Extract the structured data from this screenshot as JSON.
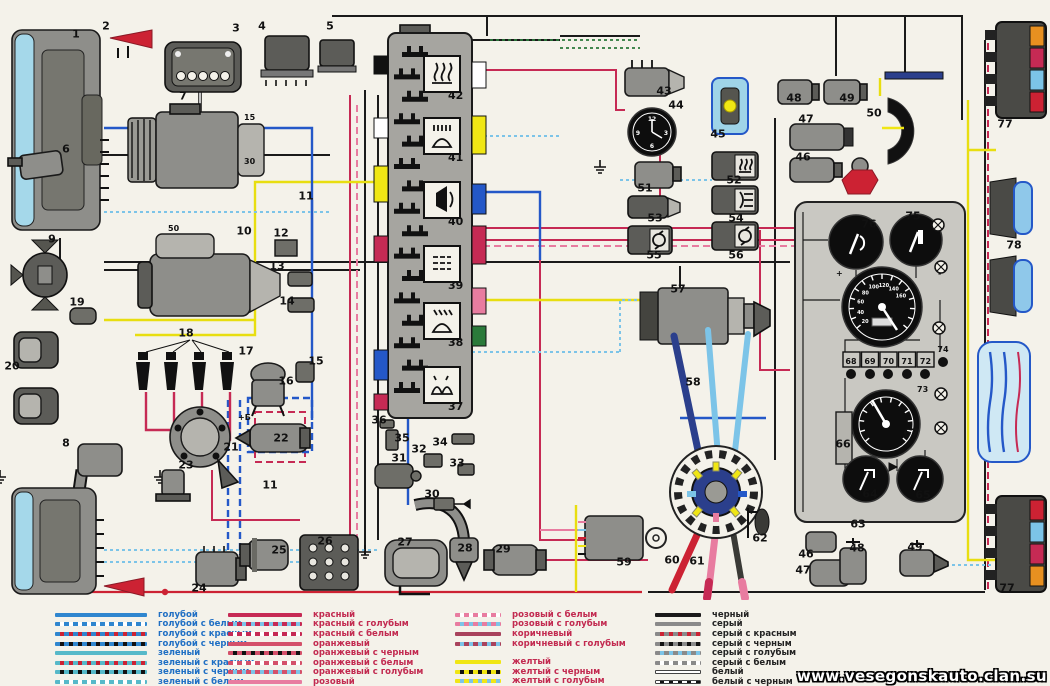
{
  "watermark": "www.vesegonskauto.clan.su",
  "labels": {
    "coil_terminal": "+Б",
    "starter_terminal": "50",
    "gen_terminal_15": "15",
    "gen_terminal_30": "30",
    "plus": "+",
    "minus": "-"
  },
  "fusebox": {
    "icons": [
      {
        "n": "42",
        "icon": "heated-rear-window"
      },
      {
        "n": "41",
        "icon": "high-beam"
      },
      {
        "n": "40",
        "icon": "horn"
      },
      {
        "n": "39",
        "icon": "heater"
      },
      {
        "n": "38",
        "icon": "low-beam"
      },
      {
        "n": "37",
        "icon": "parking-lights"
      }
    ]
  },
  "instrument": {
    "terminals": [
      "68",
      "69",
      "70",
      "71",
      "72"
    ],
    "terminal_73": "73",
    "terminal_74": "74",
    "speedometer_scale": [
      "20",
      "40",
      "60",
      "80",
      "100",
      "120",
      "140",
      "160"
    ],
    "clock_numbers": [
      "12",
      "3",
      "6",
      "9"
    ]
  },
  "callouts": [
    {
      "n": "1",
      "x": 76,
      "y": 34
    },
    {
      "n": "2",
      "x": 106,
      "y": 26
    },
    {
      "n": "3",
      "x": 236,
      "y": 28
    },
    {
      "n": "4",
      "x": 262,
      "y": 26
    },
    {
      "n": "5",
      "x": 330,
      "y": 26
    },
    {
      "n": "6",
      "x": 66,
      "y": 149
    },
    {
      "n": "7",
      "x": 183,
      "y": 96
    },
    {
      "n": "8",
      "x": 66,
      "y": 443
    },
    {
      "n": "9",
      "x": 52,
      "y": 239
    },
    {
      "n": "10",
      "x": 244,
      "y": 231
    },
    {
      "n": "11",
      "x": 306,
      "y": 196
    },
    {
      "n": "11",
      "x": 270,
      "y": 485
    },
    {
      "n": "12",
      "x": 281,
      "y": 233
    },
    {
      "n": "13",
      "x": 277,
      "y": 266
    },
    {
      "n": "14",
      "x": 287,
      "y": 301
    },
    {
      "n": "15",
      "x": 316,
      "y": 361
    },
    {
      "n": "16",
      "x": 286,
      "y": 381
    },
    {
      "n": "17",
      "x": 246,
      "y": 351
    },
    {
      "n": "18",
      "x": 186,
      "y": 333
    },
    {
      "n": "19",
      "x": 77,
      "y": 302
    },
    {
      "n": "20",
      "x": 12,
      "y": 366
    },
    {
      "n": "21",
      "x": 231,
      "y": 447
    },
    {
      "n": "22",
      "x": 281,
      "y": 438
    },
    {
      "n": "23",
      "x": 186,
      "y": 465
    },
    {
      "n": "24",
      "x": 199,
      "y": 588
    },
    {
      "n": "25",
      "x": 279,
      "y": 550
    },
    {
      "n": "26",
      "x": 325,
      "y": 541
    },
    {
      "n": "27",
      "x": 405,
      "y": 542
    },
    {
      "n": "28",
      "x": 465,
      "y": 548
    },
    {
      "n": "29",
      "x": 503,
      "y": 549
    },
    {
      "n": "30",
      "x": 432,
      "y": 494
    },
    {
      "n": "31",
      "x": 399,
      "y": 458
    },
    {
      "n": "32",
      "x": 419,
      "y": 449
    },
    {
      "n": "33",
      "x": 457,
      "y": 463
    },
    {
      "n": "34",
      "x": 440,
      "y": 442
    },
    {
      "n": "35",
      "x": 402,
      "y": 438
    },
    {
      "n": "36",
      "x": 379,
      "y": 420
    },
    {
      "n": "43",
      "x": 664,
      "y": 91
    },
    {
      "n": "44",
      "x": 676,
      "y": 105
    },
    {
      "n": "45",
      "x": 718,
      "y": 134
    },
    {
      "n": "46",
      "x": 803,
      "y": 157
    },
    {
      "n": "47",
      "x": 806,
      "y": 119
    },
    {
      "n": "48",
      "x": 794,
      "y": 98
    },
    {
      "n": "49",
      "x": 847,
      "y": 98
    },
    {
      "n": "50",
      "x": 874,
      "y": 113
    },
    {
      "n": "51",
      "x": 645,
      "y": 188
    },
    {
      "n": "52",
      "x": 734,
      "y": 180
    },
    {
      "n": "53",
      "x": 655,
      "y": 218
    },
    {
      "n": "54",
      "x": 736,
      "y": 218
    },
    {
      "n": "55",
      "x": 654,
      "y": 255
    },
    {
      "n": "56",
      "x": 736,
      "y": 255
    },
    {
      "n": "57",
      "x": 678,
      "y": 289
    },
    {
      "n": "58",
      "x": 693,
      "y": 382
    },
    {
      "n": "59",
      "x": 624,
      "y": 562
    },
    {
      "n": "60",
      "x": 672,
      "y": 560
    },
    {
      "n": "61",
      "x": 697,
      "y": 561
    },
    {
      "n": "62",
      "x": 760,
      "y": 538
    },
    {
      "n": "63",
      "x": 858,
      "y": 524
    },
    {
      "n": "64",
      "x": 870,
      "y": 494
    },
    {
      "n": "65",
      "x": 923,
      "y": 495
    },
    {
      "n": "66",
      "x": 843,
      "y": 444
    },
    {
      "n": "67",
      "x": 911,
      "y": 433
    },
    {
      "n": "75",
      "x": 913,
      "y": 216
    },
    {
      "n": "76",
      "x": 869,
      "y": 224
    },
    {
      "n": "77",
      "x": 1005,
      "y": 124
    },
    {
      "n": "77",
      "x": 1007,
      "y": 588
    },
    {
      "n": "78",
      "x": 1014,
      "y": 245
    },
    {
      "n": "46",
      "x": 806,
      "y": 554
    },
    {
      "n": "47",
      "x": 803,
      "y": 570
    },
    {
      "n": "48",
      "x": 857,
      "y": 548
    },
    {
      "n": "49",
      "x": 915,
      "y": 547
    }
  ],
  "legend": {
    "groups": [
      {
        "text_color": "#1f6fc4",
        "items": [
          {
            "label": "голубой",
            "base": "#2f86cf"
          },
          {
            "label": "голубой с белым",
            "base": "#2f86cf",
            "mark": "#ffffff"
          },
          {
            "label": "голубой с красным",
            "base": "#2f86cf",
            "mark": "#cc2233"
          },
          {
            "label": "голубой с черным",
            "base": "#2f86cf",
            "mark": "#111111"
          },
          {
            "label": "зеленый",
            "base": "#56b9c9"
          },
          {
            "label": "зеленый с красным",
            "base": "#56b9c9",
            "mark": "#cc2233"
          },
          {
            "label": "зеленый с черным",
            "base": "#56b9c9",
            "mark": "#111111"
          },
          {
            "label": "зеленый с белым",
            "base": "#56b9c9",
            "mark": "#ffffff"
          }
        ]
      },
      {
        "text_color": "#c22a50",
        "items": [
          {
            "label": "красный",
            "base": "#c62a54"
          },
          {
            "label": "красный с голубым",
            "base": "#c62a54",
            "mark": "#7cc4e8"
          },
          {
            "label": "красный с белым",
            "base": "#c62a54",
            "mark": "#ffffff"
          },
          {
            "label": "оранжевый",
            "base": "#d4506a"
          },
          {
            "label": "оранжевый с черным",
            "base": "#d4506a",
            "mark": "#111111"
          },
          {
            "label": "оранжевый с белым",
            "base": "#d4506a",
            "mark": "#ffffff"
          },
          {
            "label": "оранжевый с голубым",
            "base": "#d4506a",
            "mark": "#7cc4e8"
          },
          {
            "label": "розовый",
            "base": "#e87ca0"
          },
          {
            "label": "розовый с черным",
            "base": "#e87ca0",
            "mark": "#111111"
          }
        ]
      },
      {
        "text_color": "#c22a50",
        "items": [
          {
            "label": "розовый с белым",
            "base": "#e87ca0",
            "mark": "#ffffff"
          },
          {
            "label": "розовый с голубым",
            "base": "#e87ca0",
            "mark": "#7cc4e8"
          },
          {
            "label": "коричневый",
            "base": "#a8425c"
          },
          {
            "label": "коричневый с голубым",
            "base": "#a8425c",
            "mark": "#7cc4e8"
          },
          {
            "label": "желтый",
            "base": "#f0e614",
            "gap": true
          },
          {
            "label": "желтый с черным",
            "base": "#f0e614",
            "mark": "#111111"
          },
          {
            "label": "желтый с голубым",
            "base": "#f0e614",
            "mark": "#7cc4e8"
          },
          {
            "label": "желтый с красным",
            "base": "#f0e614",
            "mark": "#cc2233"
          }
        ]
      },
      {
        "text_color": "#222222",
        "items": [
          {
            "label": "черный",
            "base": "#1a1a1a"
          },
          {
            "label": "серый",
            "base": "#8a8a8a"
          },
          {
            "label": "серый с красным",
            "base": "#8a8a8a",
            "mark": "#cc2233"
          },
          {
            "label": "серый с черным",
            "base": "#8a8a8a",
            "mark": "#111111"
          },
          {
            "label": "серый с голубым",
            "base": "#8a8a8a",
            "mark": "#7cc4e8"
          },
          {
            "label": "серый с белым",
            "base": "#8a8a8a",
            "mark": "#ffffff"
          },
          {
            "label": "белый",
            "base": "#ffffff",
            "outline": true
          },
          {
            "label": "белый с черным",
            "base": "#ffffff",
            "mark": "#111111",
            "outline": true
          }
        ]
      }
    ]
  }
}
